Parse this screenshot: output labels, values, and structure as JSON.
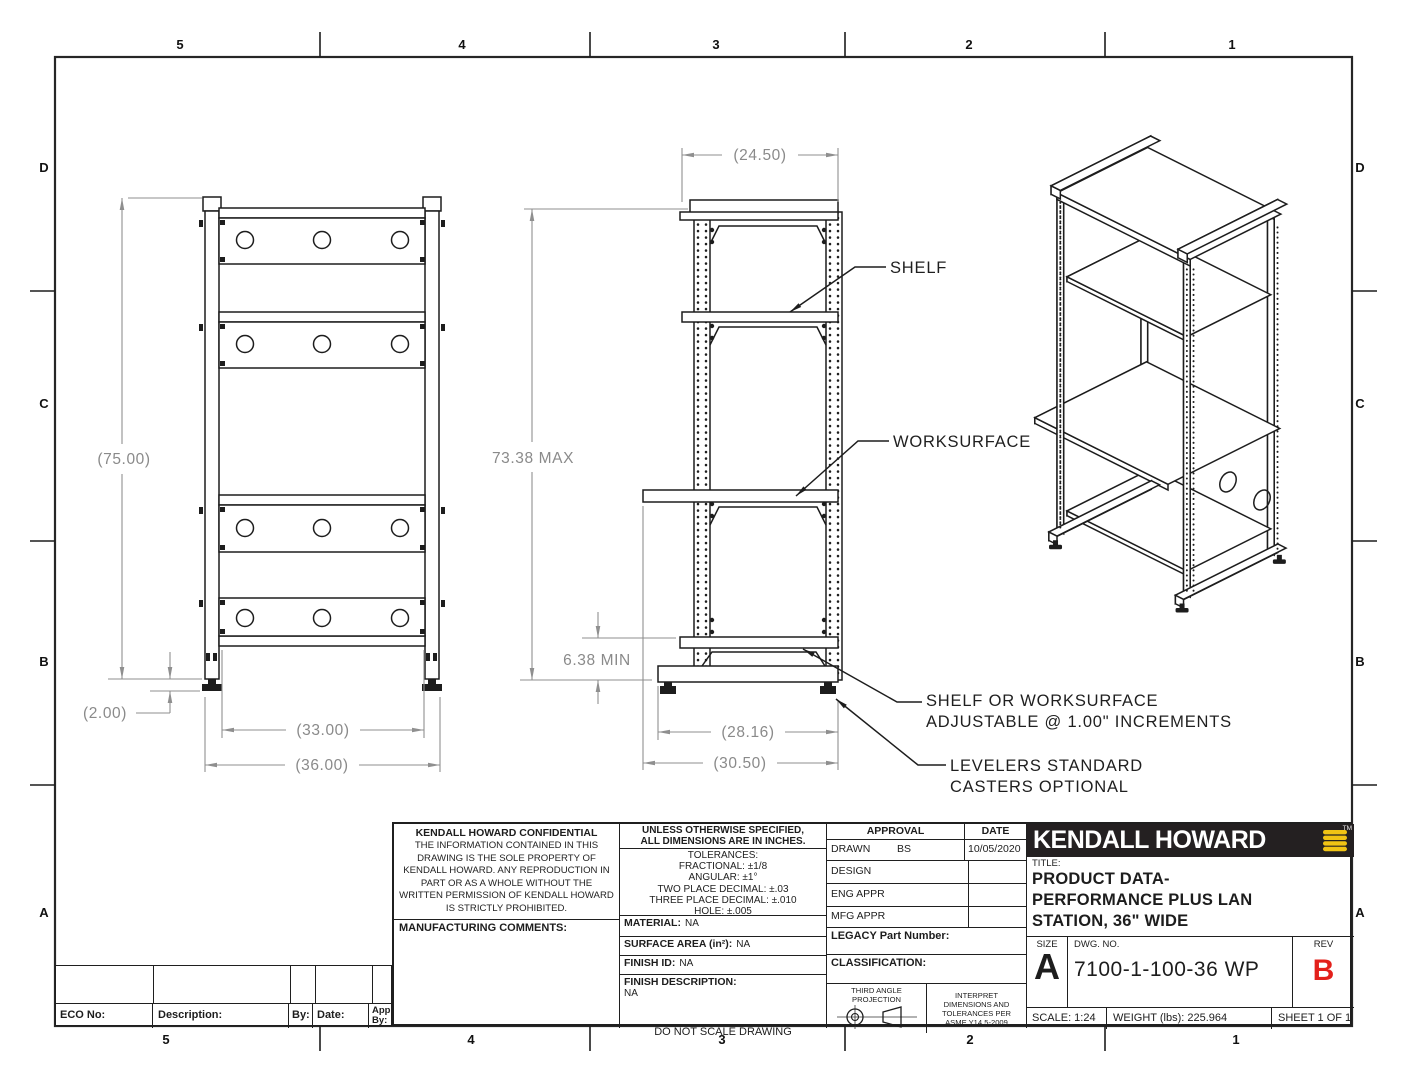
{
  "zones": {
    "top": [
      "5",
      "4",
      "3",
      "2",
      "1"
    ],
    "bottom": [
      "5",
      "4",
      "3",
      "2",
      "1"
    ],
    "left": [
      "D",
      "C",
      "B",
      "A"
    ],
    "right": [
      "D",
      "C",
      "B",
      "A"
    ]
  },
  "views": {
    "front": {
      "dims": {
        "height": "(75.00)",
        "leveler": "(2.00)",
        "inner_width": "(33.00)",
        "outer_width": "(36.00)"
      }
    },
    "side": {
      "dims": {
        "depth": "(24.50)",
        "max_height": "73.38 MAX",
        "min_clearance": "6.38 MIN",
        "base_depth": "(28.16)",
        "worksurface_depth": "(30.50)"
      },
      "callouts": {
        "shelf": "SHELF",
        "worksurface": "WORKSURFACE",
        "adjust_1": "SHELF OR WORKSURFACE",
        "adjust_2": "ADJUSTABLE @ 1.00\" INCREMENTS",
        "levelers_1": "LEVELERS STANDARD",
        "levelers_2": "CASTERS OPTIONAL"
      }
    }
  },
  "title_block": {
    "confidential": {
      "heading": "KENDALL HOWARD CONFIDENTIAL",
      "body": "THE INFORMATION CONTAINED IN THIS DRAWING IS THE SOLE PROPERTY OF KENDALL HOWARD.  ANY REPRODUCTION IN PART OR AS A WHOLE WITHOUT THE WRITTEN PERMISSION OF KENDALL HOWARD IS STRICTLY PROHIBITED.",
      "manufacturing": "MANUFACTURING COMMENTS:"
    },
    "spec": {
      "unless1": "UNLESS OTHERWISE SPECIFIED,",
      "unless2": "ALL DIMENSIONS ARE IN INCHES.",
      "tol_title": "TOLERANCES:",
      "tol_lines": [
        "FRACTIONAL: ±1/8",
        "ANGULAR: ±1°",
        "TWO PLACE DECIMAL: ±.03",
        "THREE PLACE DECIMAL: ±.010",
        "HOLE: ±.005"
      ],
      "material_label": "MATERIAL:",
      "material": "NA",
      "surface_label": "SURFACE AREA (in²):",
      "surface": "NA",
      "finish_id_label": "FINISH ID:",
      "finish_id": "NA",
      "finish_desc_label": "FINISH DESCRIPTION:",
      "finish_desc": "NA",
      "do_not_scale": "DO NOT SCALE DRAWING"
    },
    "approval": {
      "header_approval": "APPROVAL",
      "header_date": "DATE",
      "rows": [
        {
          "label": "DRAWN",
          "by": "BS",
          "date": "10/05/2020"
        },
        {
          "label": "DESIGN",
          "by": "",
          "date": ""
        },
        {
          "label": "ENG APPR",
          "by": "",
          "date": ""
        },
        {
          "label": "MFG APPR",
          "by": "",
          "date": ""
        }
      ],
      "legacy_label": "LEGACY Part Number:",
      "classification_label": "CLASSIFICATION:",
      "projection_label_1": "THIRD ANGLE",
      "projection_label_2": "PROJECTION",
      "interpret": "INTERPRET DIMENSIONS AND TOLERANCES PER ASME Y14.5-2009"
    },
    "brand": {
      "logo_text": "KENDALL HOWARD",
      "tm": "TM",
      "logo_color": "#f0c314",
      "band_color": "#242021"
    },
    "title_label": "TITLE:",
    "title_lines": [
      "PRODUCT DATA-",
      "PERFORMANCE PLUS LAN",
      "STATION, 36\" WIDE"
    ],
    "size_label": "SIZE",
    "size": "A",
    "dwg_label": "DWG.  NO.",
    "dwg_no": "7100-1-100-36 WP",
    "rev_label": "REV",
    "rev": "B",
    "rev_color": "#e3201b",
    "scale": "SCALE: 1:24",
    "weight": "WEIGHT (lbs): 225.964",
    "sheet": "SHEET 1 OF 1"
  },
  "eco": {
    "eco_no": "ECO No:",
    "description": "Description:",
    "by": "By:",
    "date": "Date:",
    "app_by_1": "App",
    "app_by_2": "By:"
  }
}
